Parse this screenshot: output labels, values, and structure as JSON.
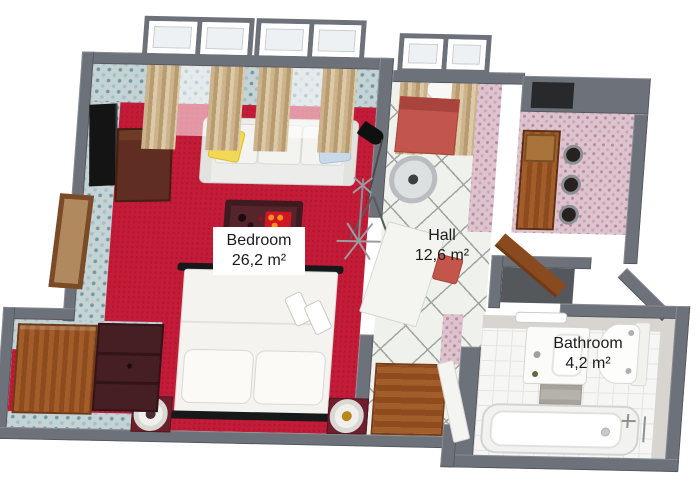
{
  "plan_title": "apartment-3d-floor-plan",
  "rooms": [
    {
      "id": "bedroom",
      "label": "Bedroom",
      "area": "26,2 m²",
      "floor": "red carpet",
      "floor_color": "#c31c39",
      "wallpaper_color": "#c6d3d5"
    },
    {
      "id": "hall",
      "label": "Hall",
      "area": "12,6 m²",
      "floor": "white diagonal tile",
      "floor_color": "#eff1ec",
      "wallpaper_color": "#dcc3ce"
    },
    {
      "id": "bathroom",
      "label": "Bathroom",
      "area": "4,2 m²",
      "floor": "white tile",
      "floor_color": "#f6f7f4",
      "wall_color": "#d8d4cf"
    }
  ],
  "colors": {
    "wall": "#6d727a",
    "background": "#ffffff",
    "wood": "#9e5526",
    "dark_furniture_red": "#56252b",
    "seat_red": "#c3564c",
    "curtain_tan": "#c2a77e",
    "label_text": "#1c1c1c",
    "label_box_bg": "#ffffff"
  },
  "furniture": {
    "bedroom": [
      "window-bay",
      "window-bay",
      "curtains",
      "sofa",
      "yellow-pillow",
      "blue-pillow",
      "coffee-table",
      "serving-tray",
      "tv",
      "tv-cabinet",
      "floor-lamp",
      "coat-rack",
      "picture-frame",
      "double-bed",
      "bed-pillow",
      "bed-pillow",
      "nightstand",
      "nightstand",
      "table-lamp",
      "table-lamp",
      "sideboard",
      "shelf-unit"
    ],
    "hall": [
      "window-bay",
      "curtains",
      "bench",
      "round-mirror",
      "open-door-white",
      "stool",
      "bar-counter",
      "bar-stool",
      "bar-stool",
      "bar-stool",
      "door-mat",
      "entry-door",
      "closet"
    ],
    "bathroom": [
      "towel-rack",
      "vanity-sink",
      "toilet",
      "storage-basket",
      "bathtub",
      "bath-faucet",
      "open-door-white"
    ]
  }
}
